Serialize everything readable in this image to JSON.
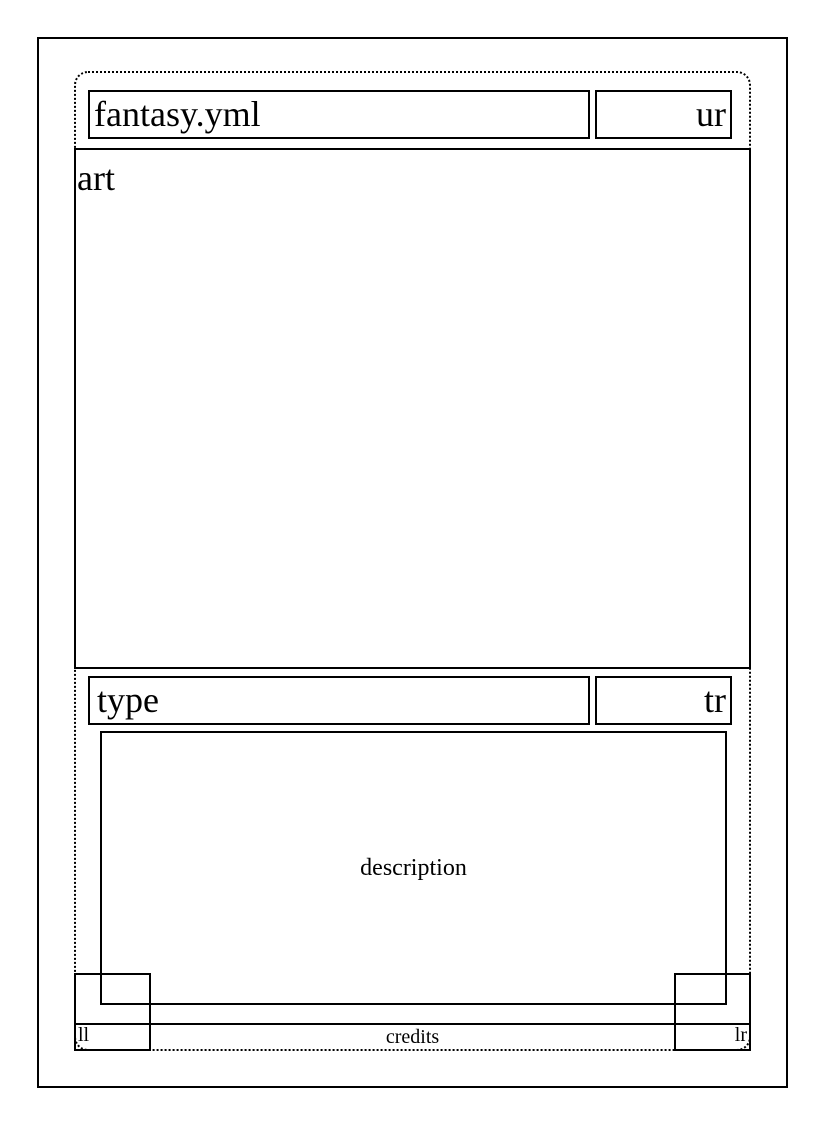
{
  "card": {
    "title": "fantasy.yml",
    "upper_right": "ur",
    "art_label": "art",
    "type": "type",
    "type_right": "tr",
    "description_label": "description",
    "lower_left": "ll",
    "credits_label": "credits",
    "lower_right": "lr"
  },
  "colors": {
    "ink": "#000000",
    "background": "#ffffff"
  }
}
